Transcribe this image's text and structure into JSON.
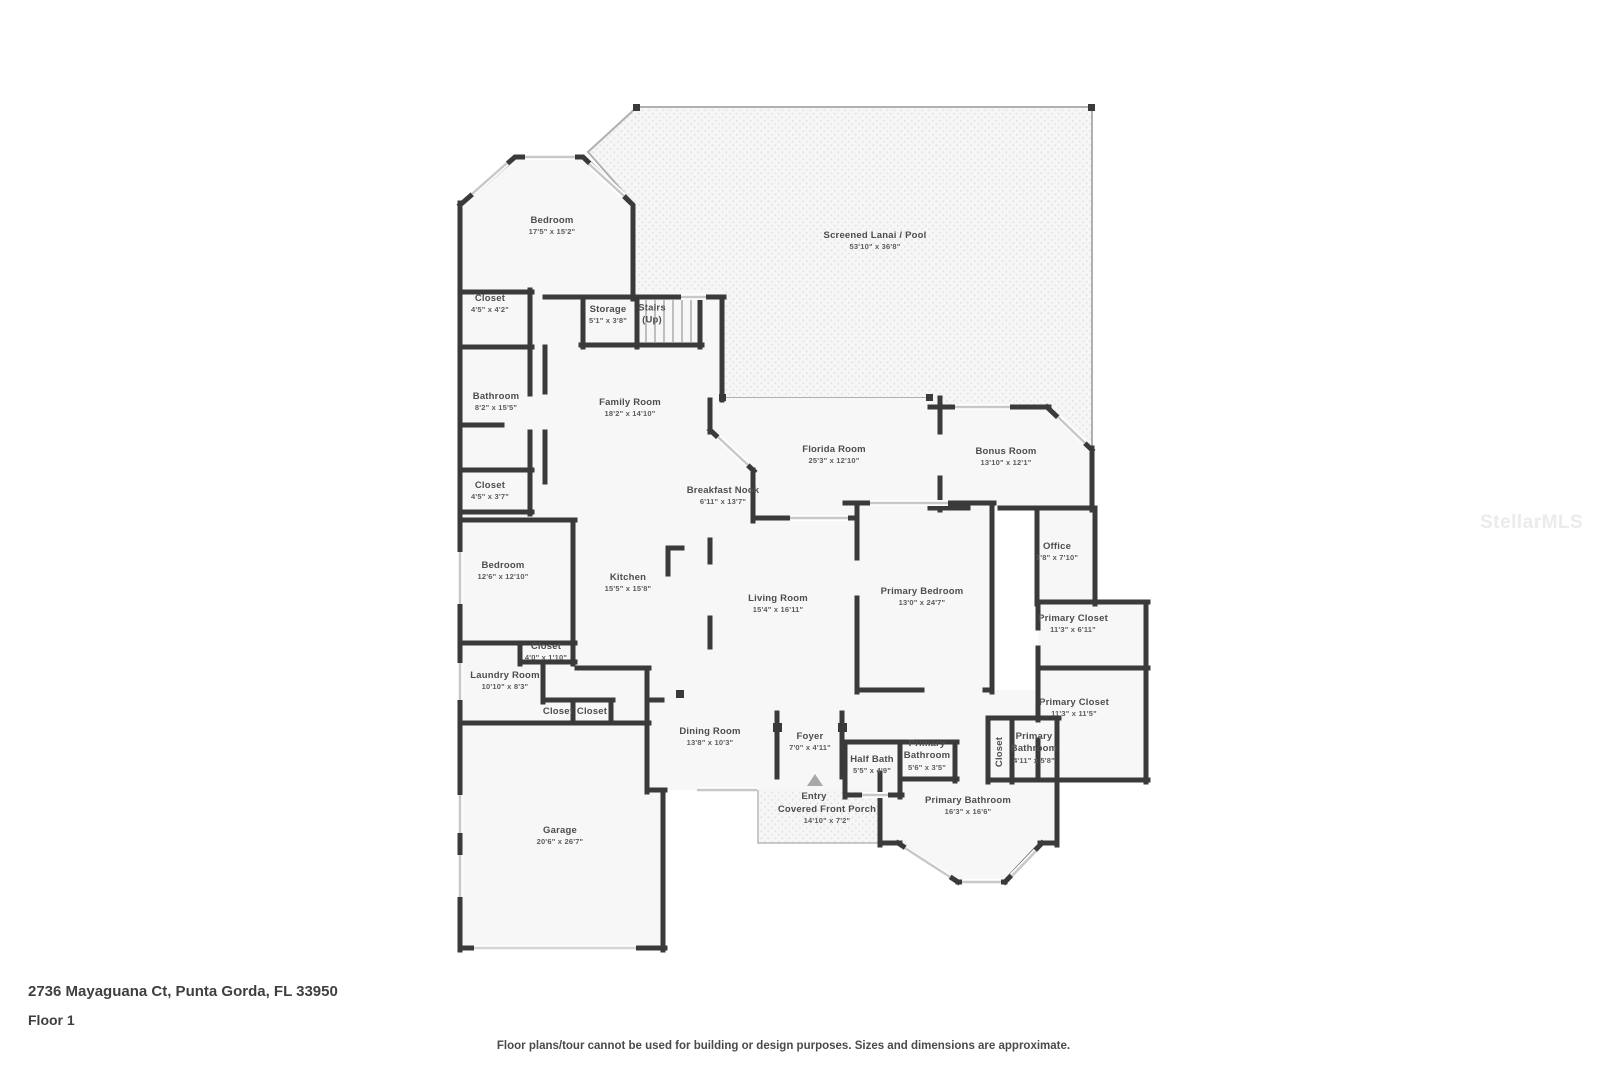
{
  "page": {
    "address": "2736 Mayaguana Ct, Punta Gorda, FL 33950",
    "floor_label": "Floor 1",
    "disclaimer": "Floor plans/tour cannot be used for building or design purposes. Sizes and dimensions are approximate.",
    "watermark": "StellarMLS"
  },
  "colors": {
    "wall": "#3a3a3a",
    "room_fill": "#f7f7f7",
    "outdoor_dot": "#e4e4e4",
    "window": "#c8c8c8",
    "label_text": "#4d4d4d"
  },
  "floor_plan": {
    "rooms": [
      {
        "name": "Bedroom",
        "dims": "17'5\" x 15'2\"",
        "x": 552,
        "y": 226
      },
      {
        "name": "Screened Lanai / Pool",
        "dims": "53'10\" x 36'8\"",
        "x": 875,
        "y": 241
      },
      {
        "name": "Closet",
        "dims": "4'5\" x 4'2\"",
        "x": 490,
        "y": 304
      },
      {
        "name": "Storage",
        "dims": "5'1\" x 3'8\"",
        "x": 608,
        "y": 315
      },
      {
        "name": "Stairs\n(Up)",
        "x": 652,
        "y": 315
      },
      {
        "name": "Bathroom",
        "dims": "8'2\" x 15'5\"",
        "x": 496,
        "y": 402
      },
      {
        "name": "Family Room",
        "dims": "18'2\" x 14'10\"",
        "x": 630,
        "y": 408
      },
      {
        "name": "Closet",
        "dims": "4'5\" x 3'7\"",
        "x": 490,
        "y": 491
      },
      {
        "name": "Breakfast Nook",
        "dims": "6'11\" x 13'7\"",
        "x": 723,
        "y": 496
      },
      {
        "name": "Florida Room",
        "dims": "25'3\" x 12'10\"",
        "x": 834,
        "y": 455
      },
      {
        "name": "Bonus Room",
        "dims": "13'10\" x 12'1\"",
        "x": 1006,
        "y": 457
      },
      {
        "name": "Office",
        "dims": "7'8\" x 7'10\"",
        "x": 1057,
        "y": 552
      },
      {
        "name": "Bedroom",
        "dims": "12'6\" x 12'10\"",
        "x": 503,
        "y": 571
      },
      {
        "name": "Kitchen",
        "dims": "15'5\" x 15'8\"",
        "x": 628,
        "y": 583
      },
      {
        "name": "Living Room",
        "dims": "15'4\" x 16'11\"",
        "x": 778,
        "y": 604
      },
      {
        "name": "Primary Bedroom",
        "dims": "13'0\" x 24'7\"",
        "x": 922,
        "y": 597
      },
      {
        "name": "Primary Closet",
        "dims": "11'3\" x 6'11\"",
        "x": 1073,
        "y": 624
      },
      {
        "name": "Primary Closet",
        "dims": "11'3\" x 11'5\"",
        "x": 1074,
        "y": 708
      },
      {
        "name": "Closet",
        "dims": "4'0\" x 1'10\"",
        "x": 546,
        "y": 652
      },
      {
        "name": "Laundry Room",
        "dims": "10'10\" x 8'3\"",
        "x": 505,
        "y": 681
      },
      {
        "name": "Closet",
        "x": 558,
        "y": 712
      },
      {
        "name": "Closet",
        "x": 592,
        "y": 712
      },
      {
        "name": "Garage",
        "dims": "20'6\" x 26'7\"",
        "x": 560,
        "y": 836
      },
      {
        "name": "Dining Room",
        "dims": "13'8\" x 10'3\"",
        "x": 710,
        "y": 737
      },
      {
        "name": "Foyer",
        "dims": "7'0\" x 4'11\"",
        "x": 810,
        "y": 742
      },
      {
        "name": "Half Bath",
        "dims": "5'5\" x 4'9\"",
        "x": 872,
        "y": 765
      },
      {
        "name": "Primary\nBathroom",
        "dims": "5'6\" x 3'5\"",
        "x": 927,
        "y": 755
      },
      {
        "name": "Closet",
        "x": 1000,
        "y": 752,
        "rotate": true
      },
      {
        "name": "Primary\nBathroom",
        "dims": "4'11\" x 5'8\"",
        "x": 1034,
        "y": 748
      },
      {
        "name": "Entry",
        "x": 814,
        "y": 797
      },
      {
        "name": "Covered Front Porch",
        "dims": "14'10\" x 7'2\"",
        "x": 827,
        "y": 815
      },
      {
        "name": "Primary Bathroom",
        "dims": "16'3\" x 16'6\"",
        "x": 968,
        "y": 806
      }
    ]
  }
}
